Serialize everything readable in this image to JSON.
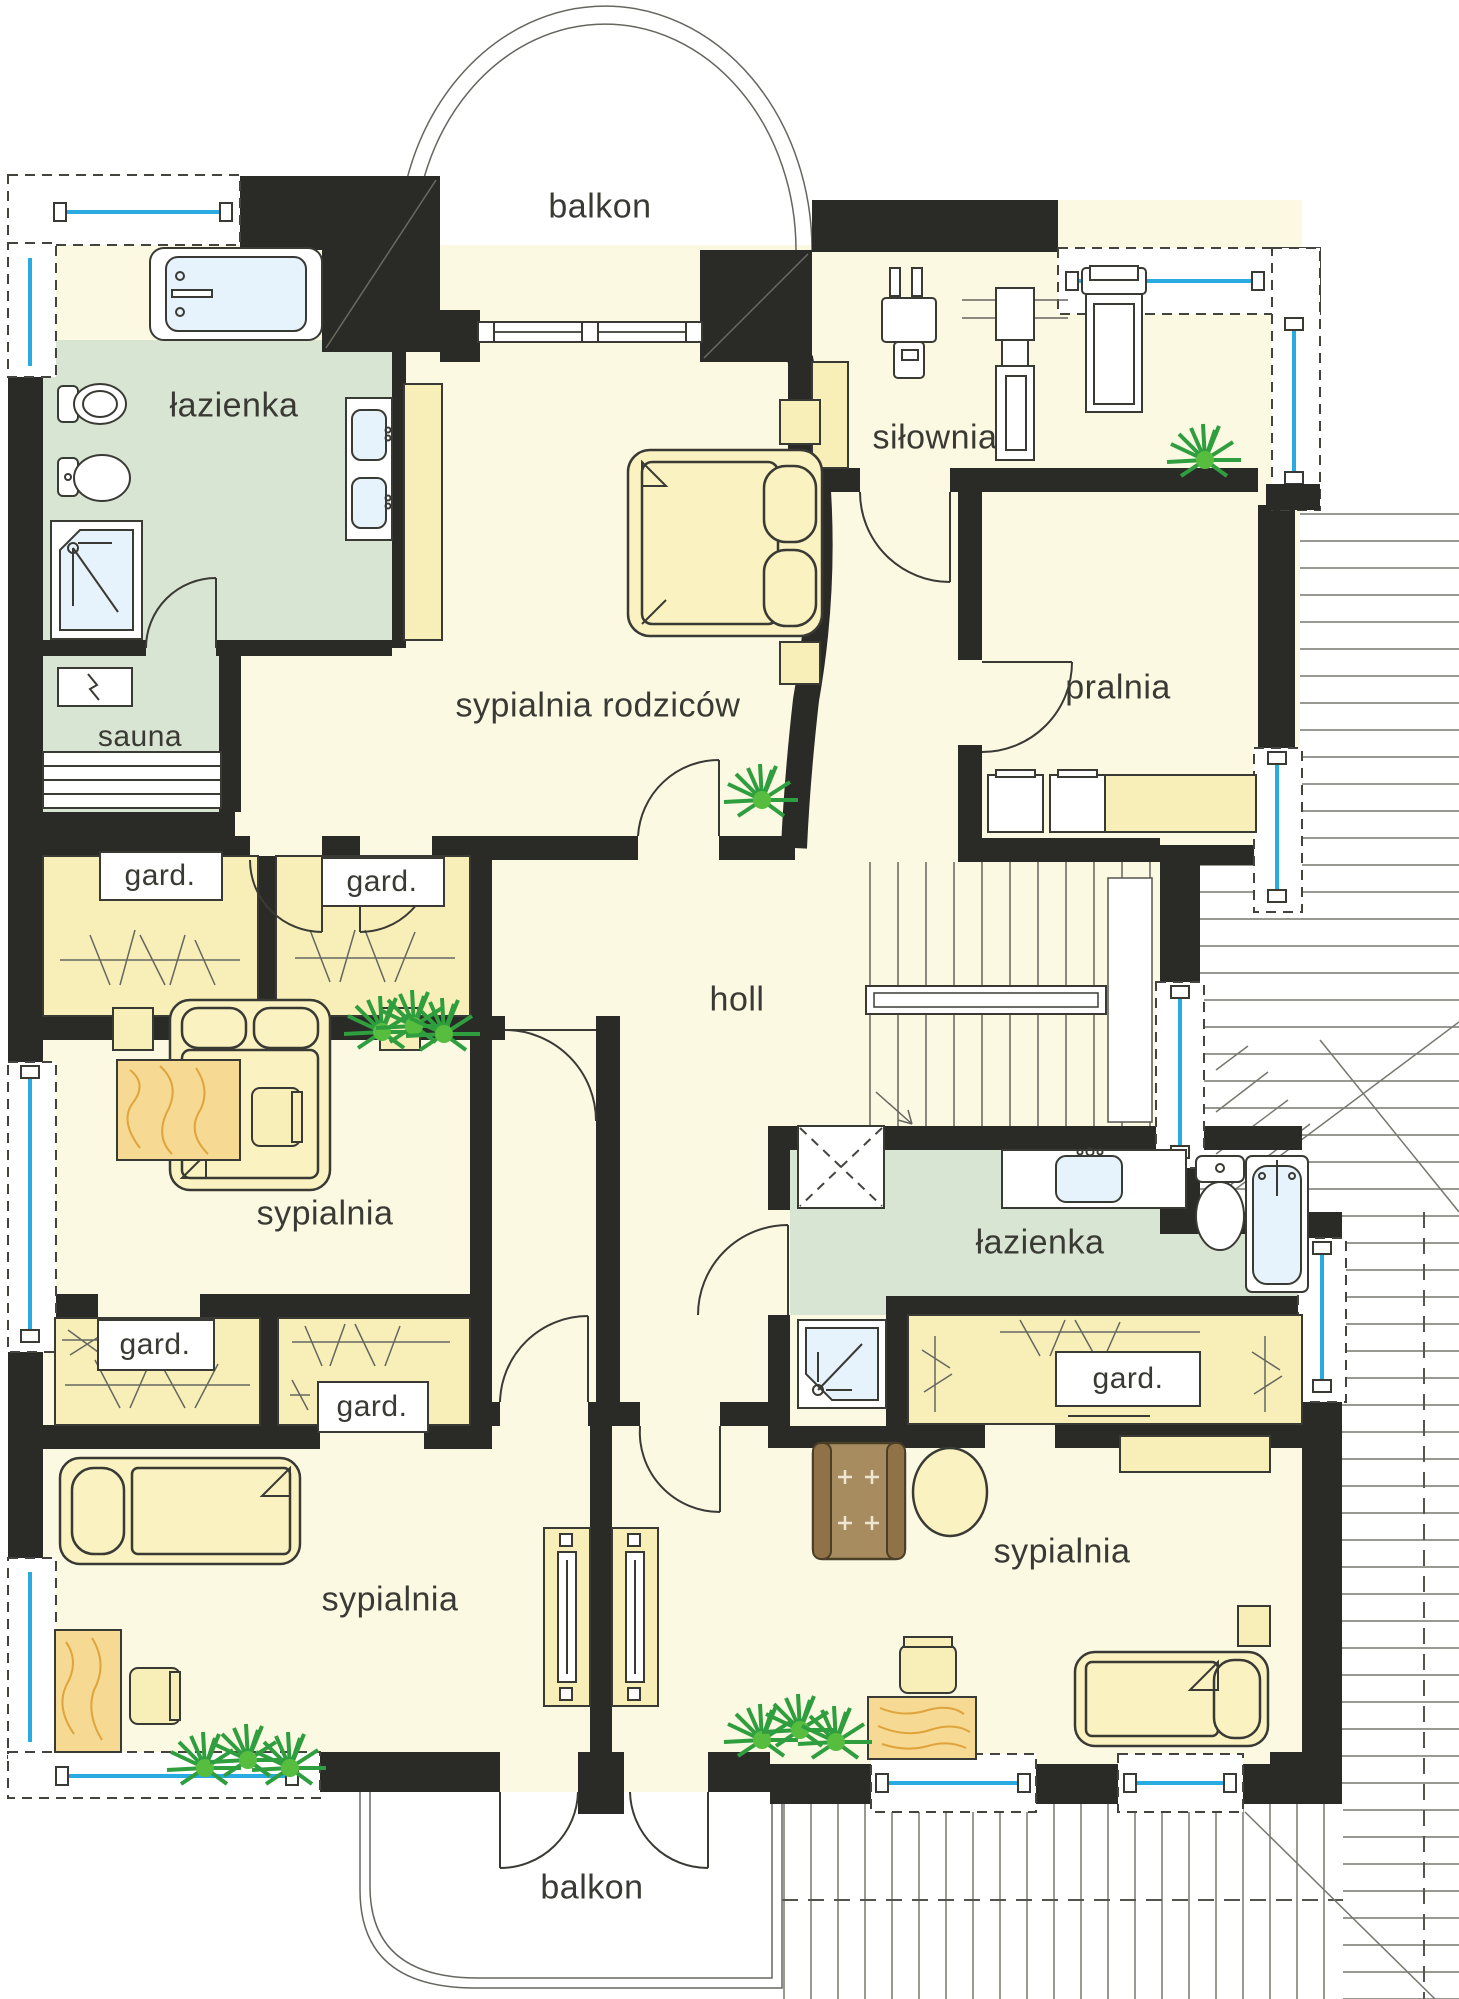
{
  "plan_title": "first floor plan",
  "palette": {
    "wall": "#2a2a26",
    "room_floor": "#fcf9e3",
    "closet_fill": "#f8efb8",
    "bath_floor": "#d9e5d3",
    "window_glass": "#29abe2",
    "wood": "#f6d993",
    "plant_green": "#2f9e3e",
    "armchair_brown": "#a78c5f"
  },
  "rooms": {
    "balcony_top": {
      "label": "balkon"
    },
    "bathroom_left": {
      "label": "łazienka"
    },
    "sauna": {
      "label": "sauna"
    },
    "master_bedroom": {
      "label": "sypialnia rodziców"
    },
    "gym": {
      "label": "siłownia"
    },
    "laundry": {
      "label": "pralnia"
    },
    "hall": {
      "label": "holl"
    },
    "wardrobe_upper_left": {
      "label": "gard."
    },
    "wardrobe_upper_right": {
      "label": "gard."
    },
    "bedroom_mid_left": {
      "label": "sypialnia"
    },
    "wardrobe_lower_left": {
      "label": "gard."
    },
    "wardrobe_lower_mid": {
      "label": "gard."
    },
    "bathroom_right": {
      "label": "łazienka"
    },
    "wardrobe_right": {
      "label": "gard."
    },
    "bedroom_bottom_left": {
      "label": "sypialnia"
    },
    "bedroom_bottom_right": {
      "label": "sypialnia"
    },
    "balcony_bottom": {
      "label": "balkon"
    }
  }
}
